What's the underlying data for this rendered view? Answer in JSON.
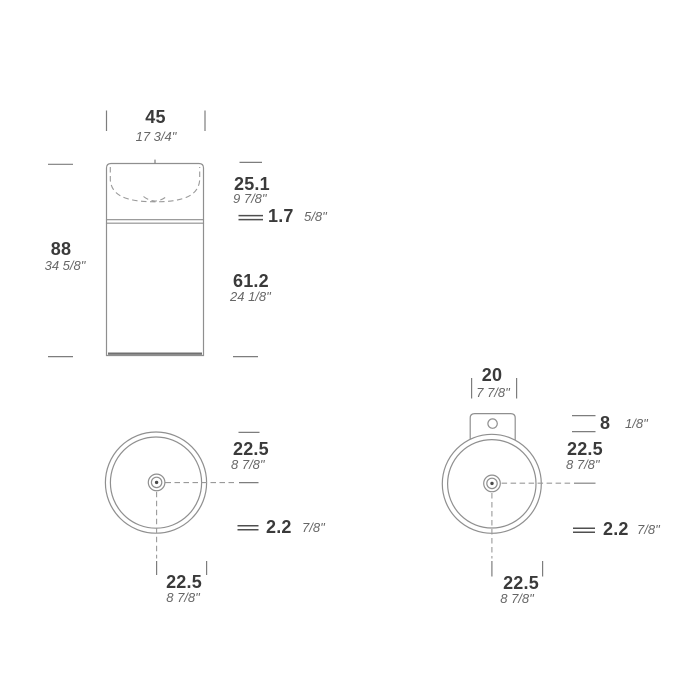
{
  "colors": {
    "background": "#ffffff",
    "drawing_line": "#8f8f8f",
    "dimension_line": "#7d7d7d",
    "thickness_symbol": "#4f4f4f",
    "text_primary": "#3a3a3a",
    "text_secondary": "#666666"
  },
  "front_view": {
    "width_cm": "45",
    "width_in": "17 3/4\"",
    "height_cm": "88",
    "height_in": "34 5/8\"",
    "basin_height_cm": "25.1",
    "basin_height_in": "9 7/8\"",
    "rim_thickness_cm": "1.7",
    "rim_thickness_in": "5/8\"",
    "pedestal_height_cm": "61.2",
    "pedestal_height_in": "24 1/8\""
  },
  "top_view_left": {
    "radius_horizontal_cm": "22.5",
    "radius_horizontal_in": "8 7/8\"",
    "wall_thickness_cm": "2.2",
    "wall_thickness_in": "7/8\"",
    "radius_vertical_cm": "22.5",
    "radius_vertical_in": "8 7/8\""
  },
  "top_view_right": {
    "bracket_width_cm": "20",
    "bracket_width_in": "7 7/8\"",
    "bracket_height_cm": "8",
    "bracket_height_in": "1/8\"",
    "radius_horizontal_cm": "22.5",
    "radius_horizontal_in": "8 7/8\"",
    "wall_thickness_cm": "2.2",
    "wall_thickness_in": "7/8\"",
    "radius_vertical_cm": "22.5",
    "radius_vertical_in": "8 7/8\""
  }
}
